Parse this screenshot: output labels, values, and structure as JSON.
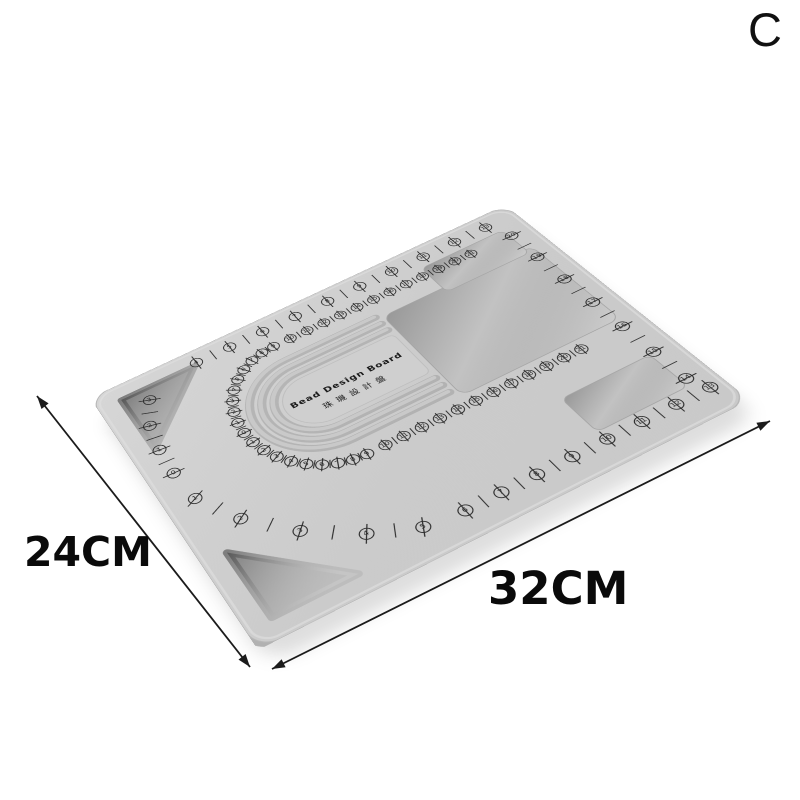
{
  "variant_label": "C",
  "dimensions": {
    "width_label": "32CM",
    "height_label": "24CM"
  },
  "board": {
    "title": "Bead Design Board",
    "subtitle_cn": "珠璣設計盤",
    "u_scale": {
      "arc": [
        "9",
        "8",
        "7",
        "6",
        "5",
        "4",
        "3",
        "2",
        "1",
        "0",
        "1",
        "2",
        "3",
        "4",
        "5",
        "6",
        "7",
        "8",
        "9"
      ],
      "arm_top": [
        "10",
        "11",
        "12",
        "13",
        "14",
        "15",
        "16",
        "17",
        "18",
        "19",
        "20",
        "21"
      ],
      "arm_bottom": [
        "10",
        "11",
        "12",
        "13",
        "14",
        "15",
        "16",
        "17",
        "18",
        "19",
        "20",
        "21"
      ]
    },
    "perimeter_scale": {
      "top": [
        "4",
        "5",
        "6",
        "7",
        "8",
        "9",
        "10",
        "11",
        "12",
        "13"
      ],
      "left_corner": [
        "3",
        "2",
        "1",
        "0"
      ],
      "bottom_left_wrap": [
        "1",
        "2",
        "3",
        "4",
        "5"
      ],
      "bottom": [
        "6",
        "7",
        "8",
        "9",
        "10",
        "11",
        "12",
        "13"
      ],
      "right": [
        "14",
        "15",
        "16",
        "17",
        "18",
        "19",
        "20"
      ]
    }
  },
  "colors": {
    "background": "#ffffff",
    "board_gray": "#cbcbcb",
    "markings": "#2b2b2b",
    "dimension_text": "#0a0a0a"
  }
}
